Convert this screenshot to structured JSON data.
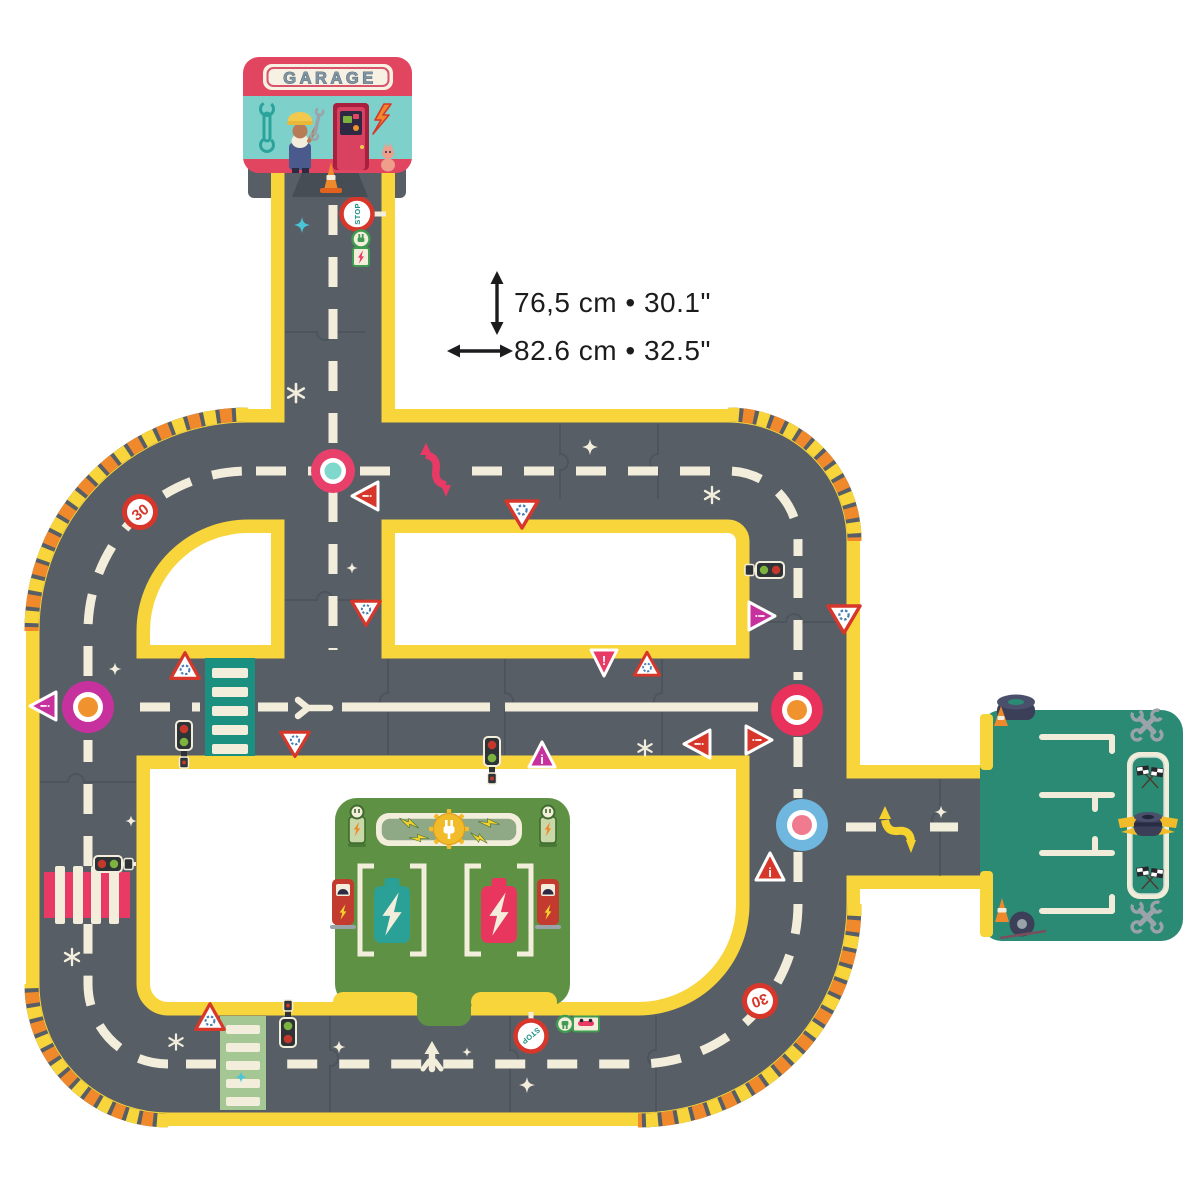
{
  "annotations": {
    "height_label": "76,5 cm • 30.1\"",
    "width_label": "82.6 cm • 32.5\""
  },
  "garage": {
    "sign": "GARAGE"
  },
  "signs": {
    "speed_limit": "30",
    "stop": "STOP",
    "exclaim": "!",
    "info": "i"
  },
  "colors": {
    "ink": "#1C1C1E",
    "road": "#575E66",
    "road-dark": "#474D54",
    "seam": "#434950",
    "edge-yellow": "#F8D53A",
    "cream": "#F3EEDC",
    "hazard-orange": "#F0892B",
    "hazard-deep": "#E2611C",
    "pink": "#E83A64",
    "crimson": "#D7372B",
    "magenta": "#C7319E",
    "garage-pink": "#E2455F",
    "teal-wall": "#7ED0CA",
    "teal-deep": "#1B9080",
    "stop-teal": "#1B9080",
    "battery-teal": "#2AA096",
    "battery-pink": "#E8365F",
    "blue-light": "#6FB7DE",
    "blue-glyph": "#4A7FB5",
    "orange": "#F0922E",
    "salmon": "#F07B8E",
    "station-green": "#5F9145",
    "pole-green": "#C9D8A8",
    "dark-green": "#3E6B2E",
    "sage": "#8FA886",
    "sage-light": "#A5C793",
    "park-teal": "#2B8A73",
    "gear-yellow": "#F2BB2A",
    "bolt-yellow": "#F5D22D",
    "metal": "#9AA3AA",
    "navy": "#3B3F58",
    "white": "#FFFFFF",
    "letter-gray": "#7F96A6",
    "letter-outline": "#445463",
    "skin": "#B97A56",
    "cap-yellow": "#F2C94C",
    "denim": "#4A5A8C",
    "door-red": "#D8415F",
    "door-frame": "#A8203E",
    "wall-wrench": "#2BA39B",
    "dark-box": "#2E3338",
    "signal-red": "#C4372B",
    "signal-green": "#7CB23E",
    "charger-red": "#C23B2E",
    "window-dark": "#2F2A44",
    "teal-sparkle": "#49C5D8",
    "cat-pink": "#EF9E8C"
  }
}
